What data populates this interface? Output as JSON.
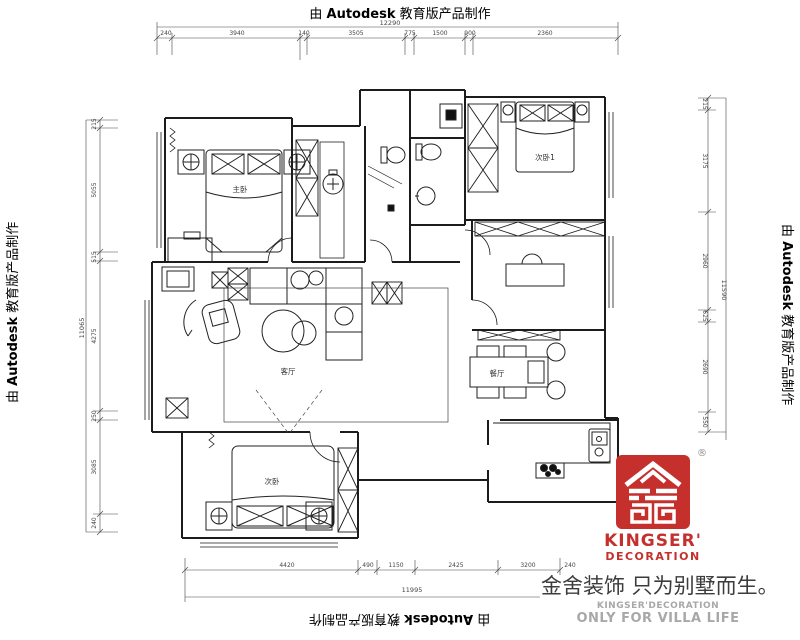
{
  "watermark": {
    "prefix": "由",
    "brand": "Autodesk",
    "suffix": "教育版产品制作"
  },
  "rooms": {
    "master": "主卧",
    "bedroom1": "次卧1",
    "bedroom2": "次卧",
    "living": "客厅",
    "dining": "餐厅"
  },
  "dims": {
    "top": {
      "total": "12290",
      "segments": [
        "240",
        "3940",
        "140",
        "3505",
        "775",
        "1500",
        "900",
        "2360"
      ]
    },
    "bottom": {
      "total": "11995",
      "segments": [
        "4420",
        "490",
        "1150",
        "2425",
        "3200",
        "240"
      ]
    },
    "left": {
      "total": "11065",
      "segments": [
        "215",
        "5055",
        "515",
        "4275",
        "250",
        "3085",
        "240"
      ]
    },
    "right": {
      "total": "11590",
      "segments": [
        "215",
        "3175",
        "2960",
        "625",
        "2690",
        "550"
      ]
    }
  },
  "brand": {
    "registered": "®",
    "logo_name": "KINGSER'",
    "logo_sub": "DECORATION",
    "slogan": "金舍装饰 只为别墅而生。",
    "subtext1": "KINGSER'DECORATION",
    "subtext2": "ONLY FOR VILLA LIFE",
    "red": "#c5302c",
    "dark": "#3c3c3c",
    "gray": "#a8a8a8"
  }
}
